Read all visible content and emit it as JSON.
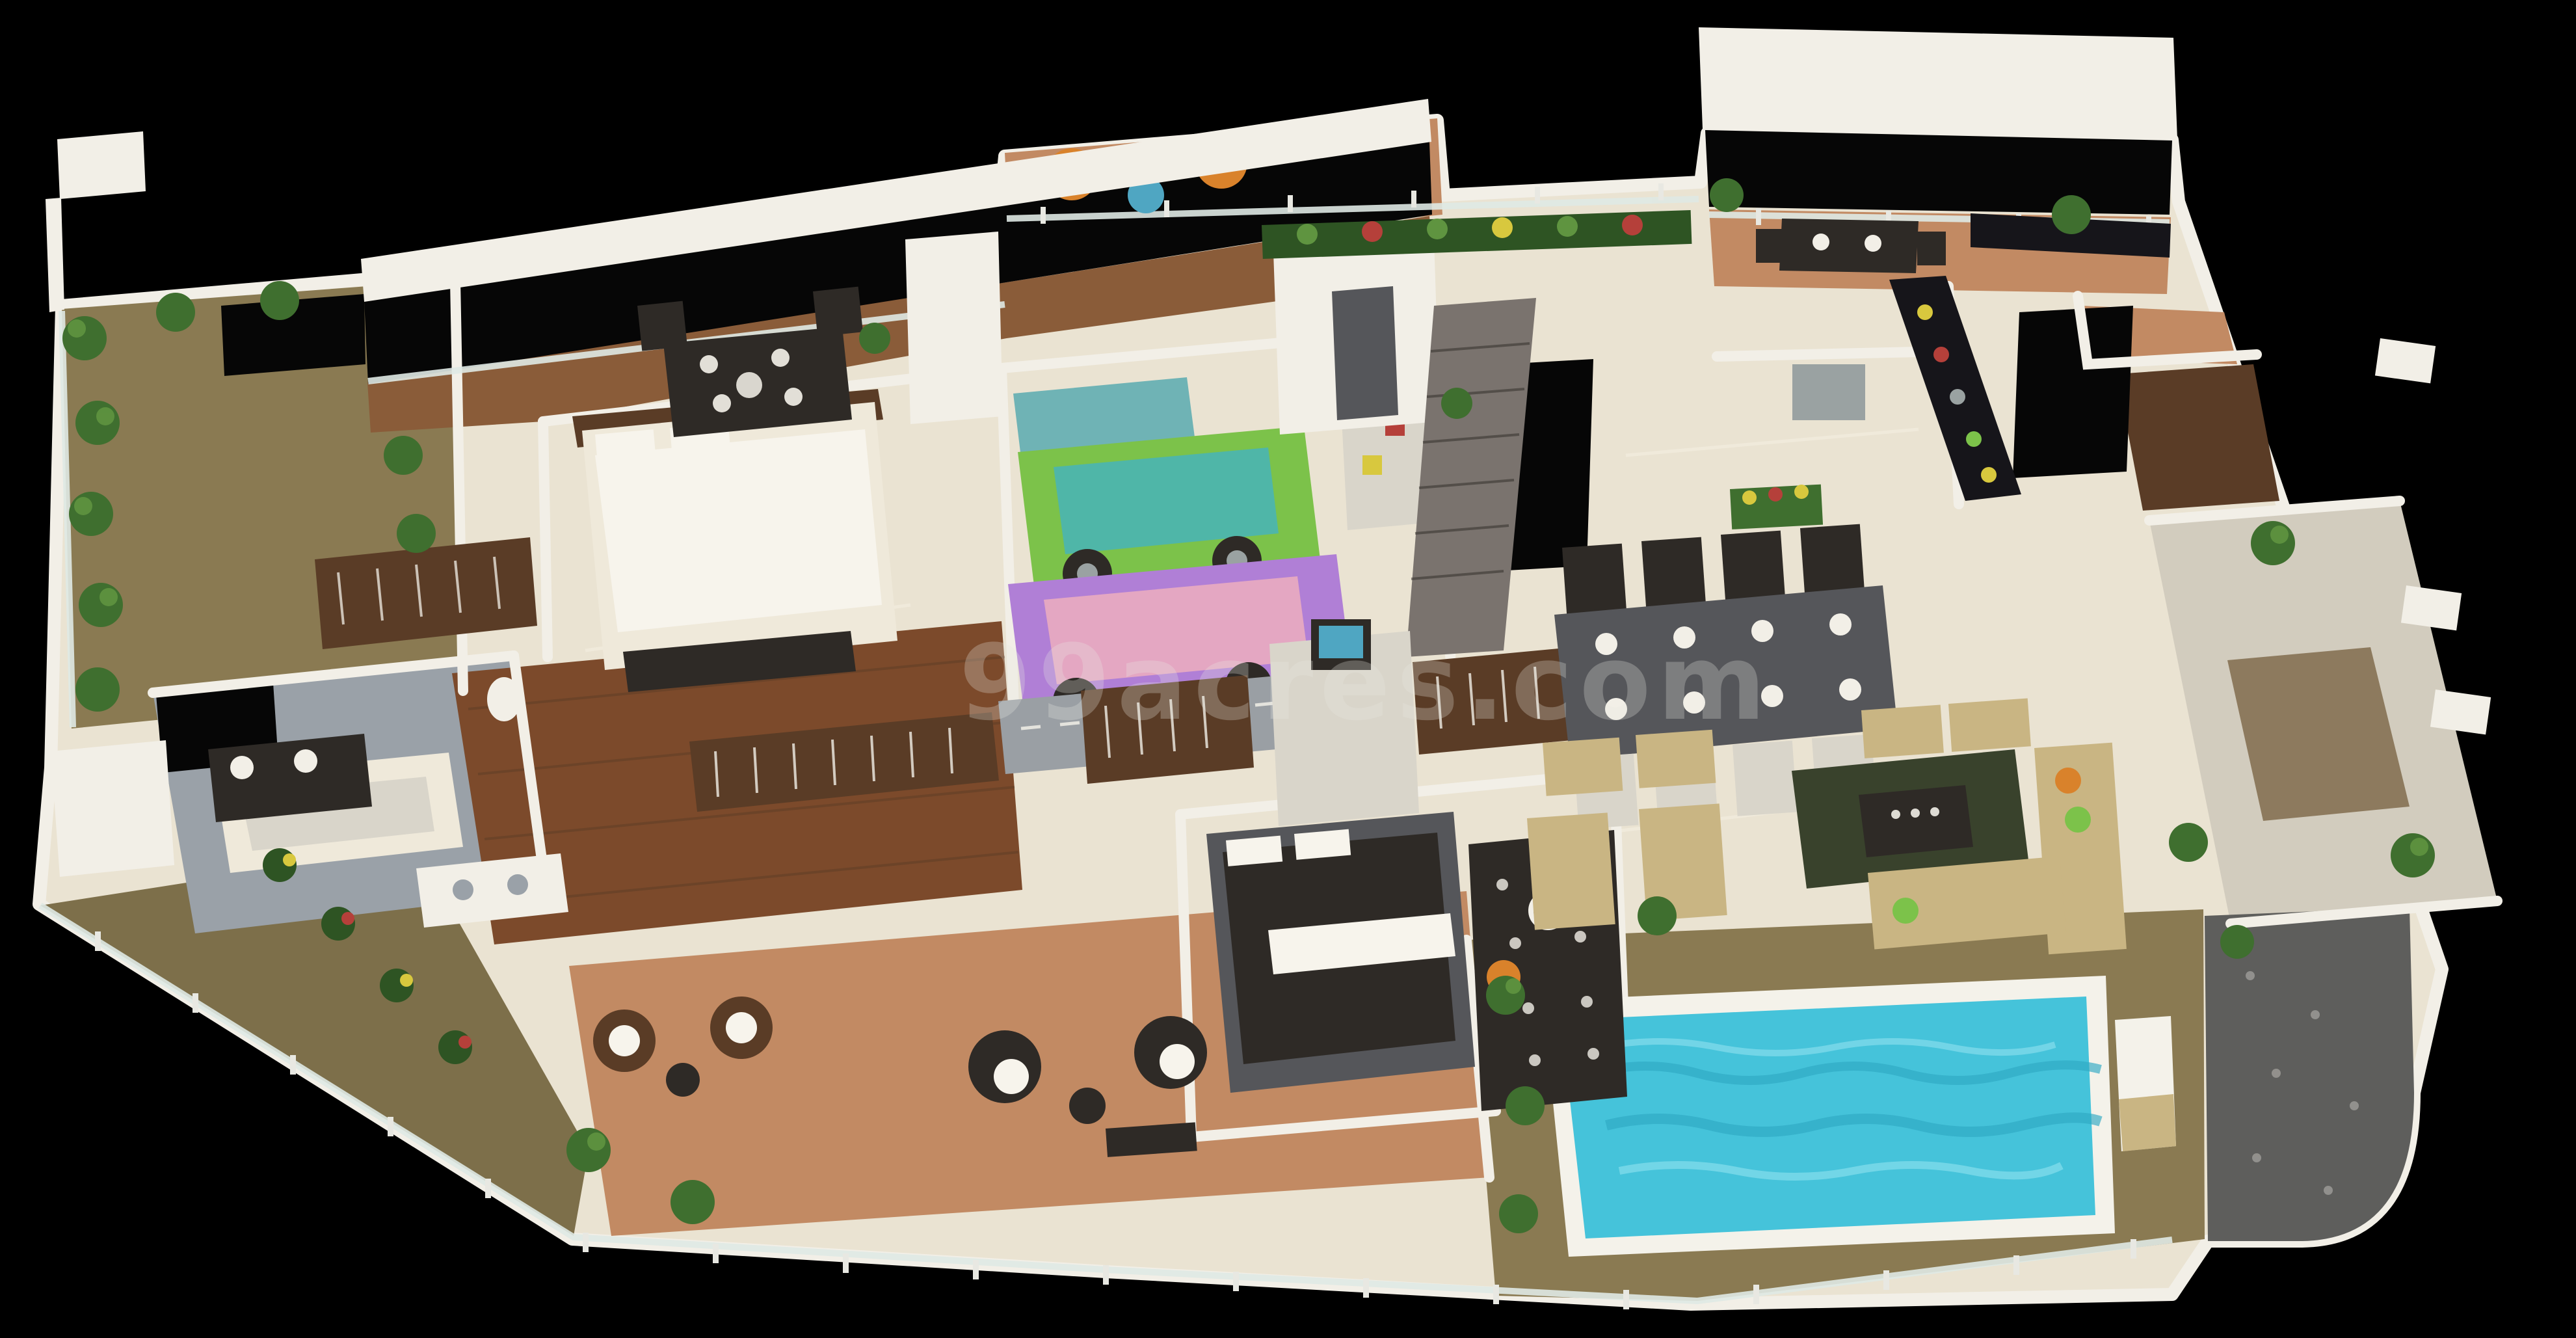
{
  "watermark": {
    "text": "99acres.com"
  },
  "colors": {
    "background": "#000000",
    "wall": "#f2efe7",
    "wall_shade": "#d9d5ca",
    "marble": "#eae3d2",
    "marble_streak": "#f6f1e4",
    "wood_floor": "#7c4a2b",
    "wood_terrace": "#8a5c39",
    "deck_olive": "#8a7a52",
    "deck_olive2": "#7d6f4a",
    "terracotta": "#c28a63",
    "tile_gray": "#9aa1a8",
    "stone": "#d2ccbe",
    "pebble": "#8d7a5e",
    "cobble": "#5e5e5c",
    "pool_water": "#45c3da",
    "pool_deep": "#2fa9c4",
    "pool_light": "#8ae0ee",
    "coping": "#f4f2ea",
    "glass": "#dfe9e4",
    "post": "#e8e8e2",
    "plant": "#3f6f2f",
    "plant_light": "#5f9440",
    "plant_dark": "#2e5423",
    "flower_yellow": "#d8c83e",
    "flower_red": "#b5403a",
    "sofa": "#c9b583",
    "sofa_light": "#d8c795",
    "rug_green": "#39422c",
    "rug_gray": "#9a9fa4",
    "rug_blue": "#6fb3b5",
    "furn_dark": "#2e2a26",
    "furn_brown": "#5a3c26",
    "counter_black": "#16151a",
    "steel": "#9aa2a2",
    "bed_white": "#efe9da",
    "bed_gray": "#55565a",
    "pillow": "#f7f4ec",
    "kid_green": "#7cc24a",
    "kid_teal": "#4fb6a8",
    "kid_purple": "#b07fd6",
    "kid_pink": "#e4a7c2",
    "accent_orange": "#d9822b",
    "accent_teal": "#4fa6c2",
    "ramp": "#7a736e",
    "void": "#060606",
    "watermark": "#e9e9e3"
  }
}
